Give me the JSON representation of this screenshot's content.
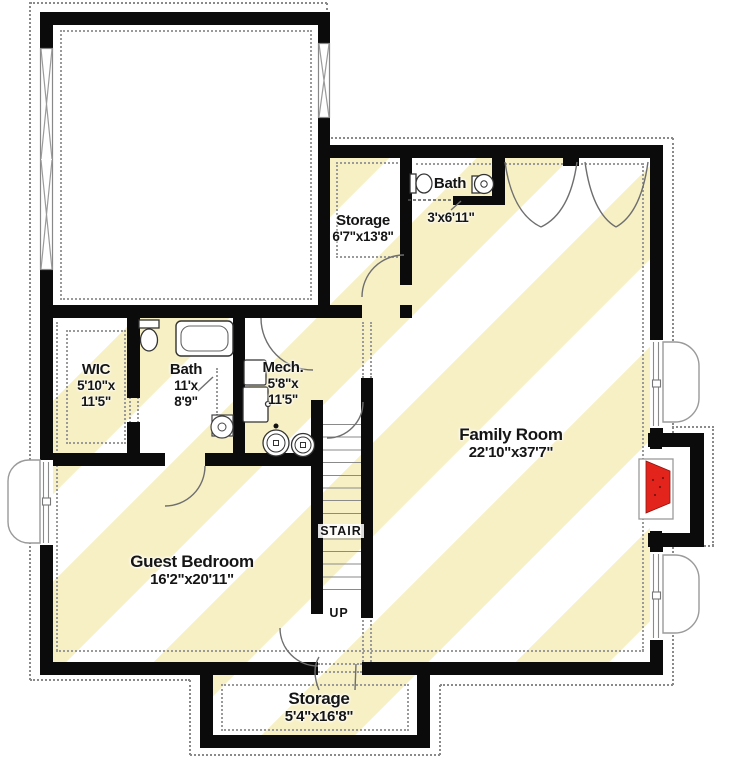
{
  "title": "Basement Floor Plan",
  "rooms": {
    "storage_top": {
      "name": "Storage",
      "dims": "6'7\"x13'8\""
    },
    "bath_top": {
      "name": "Bath",
      "dims": "3'x6'11\""
    },
    "wic": {
      "name": "WIC",
      "dims": "5'10\"x\n11'5\""
    },
    "bath_main": {
      "name": "Bath",
      "dims": "11'x\n8'9\""
    },
    "mech": {
      "name": "Mech.",
      "dims": "5'8\"x\n11'5\""
    },
    "family": {
      "name": "Family Room",
      "dims": "22'10\"x37'7\""
    },
    "guest": {
      "name": "Guest Bedroom",
      "dims": "16'2\"x20'11\""
    },
    "storage_bottom": {
      "name": "Storage",
      "dims": "5'4\"x16'8\""
    }
  },
  "labels": {
    "stair": "STAIR",
    "up": "UP"
  },
  "colors": {
    "wall": "#0b0b0b",
    "stripe_yellow": "#f7f0c5",
    "fireplace_red": "#e2241c",
    "outline_gray": "#8a8a8a",
    "fixture_line": "#444444"
  }
}
